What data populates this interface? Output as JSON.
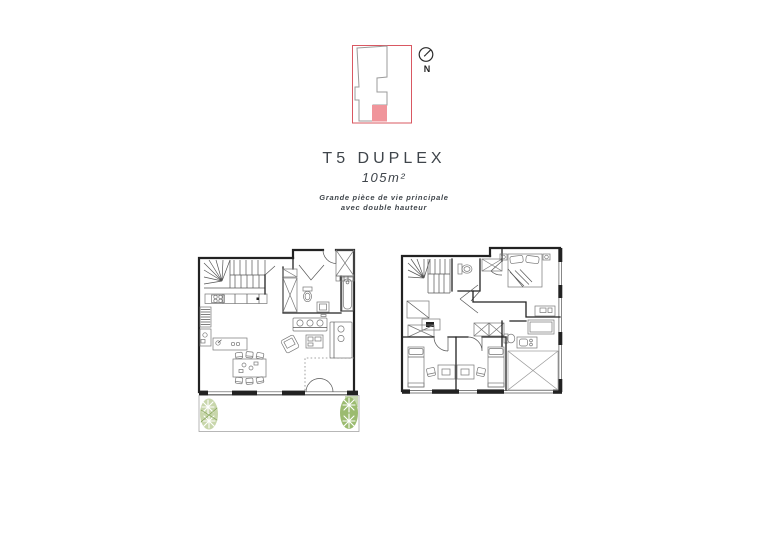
{
  "key_plan": {
    "compass_label": "N"
  },
  "title_block": {
    "title": "T5 DUPLEX",
    "area": "105m²",
    "subtitle_line1": "Grande pièce de vie principale",
    "subtitle_line2": "avec double hauteur"
  },
  "colors": {
    "accent_red": "#d95862",
    "unit_highlight": "#f0959b",
    "building_outline": "#9b9b9b",
    "wall_line": "#222222",
    "drawing_line": "#555555",
    "furniture_line": "#777777",
    "terrace_deck": "#ecdfd1",
    "terrace_deck_stripe": "#cdb29c",
    "plant_green_light": "#c8d6ab",
    "plant_green_dark": "#9bbb70",
    "text": "#3f454b",
    "void_line": "#999999"
  }
}
